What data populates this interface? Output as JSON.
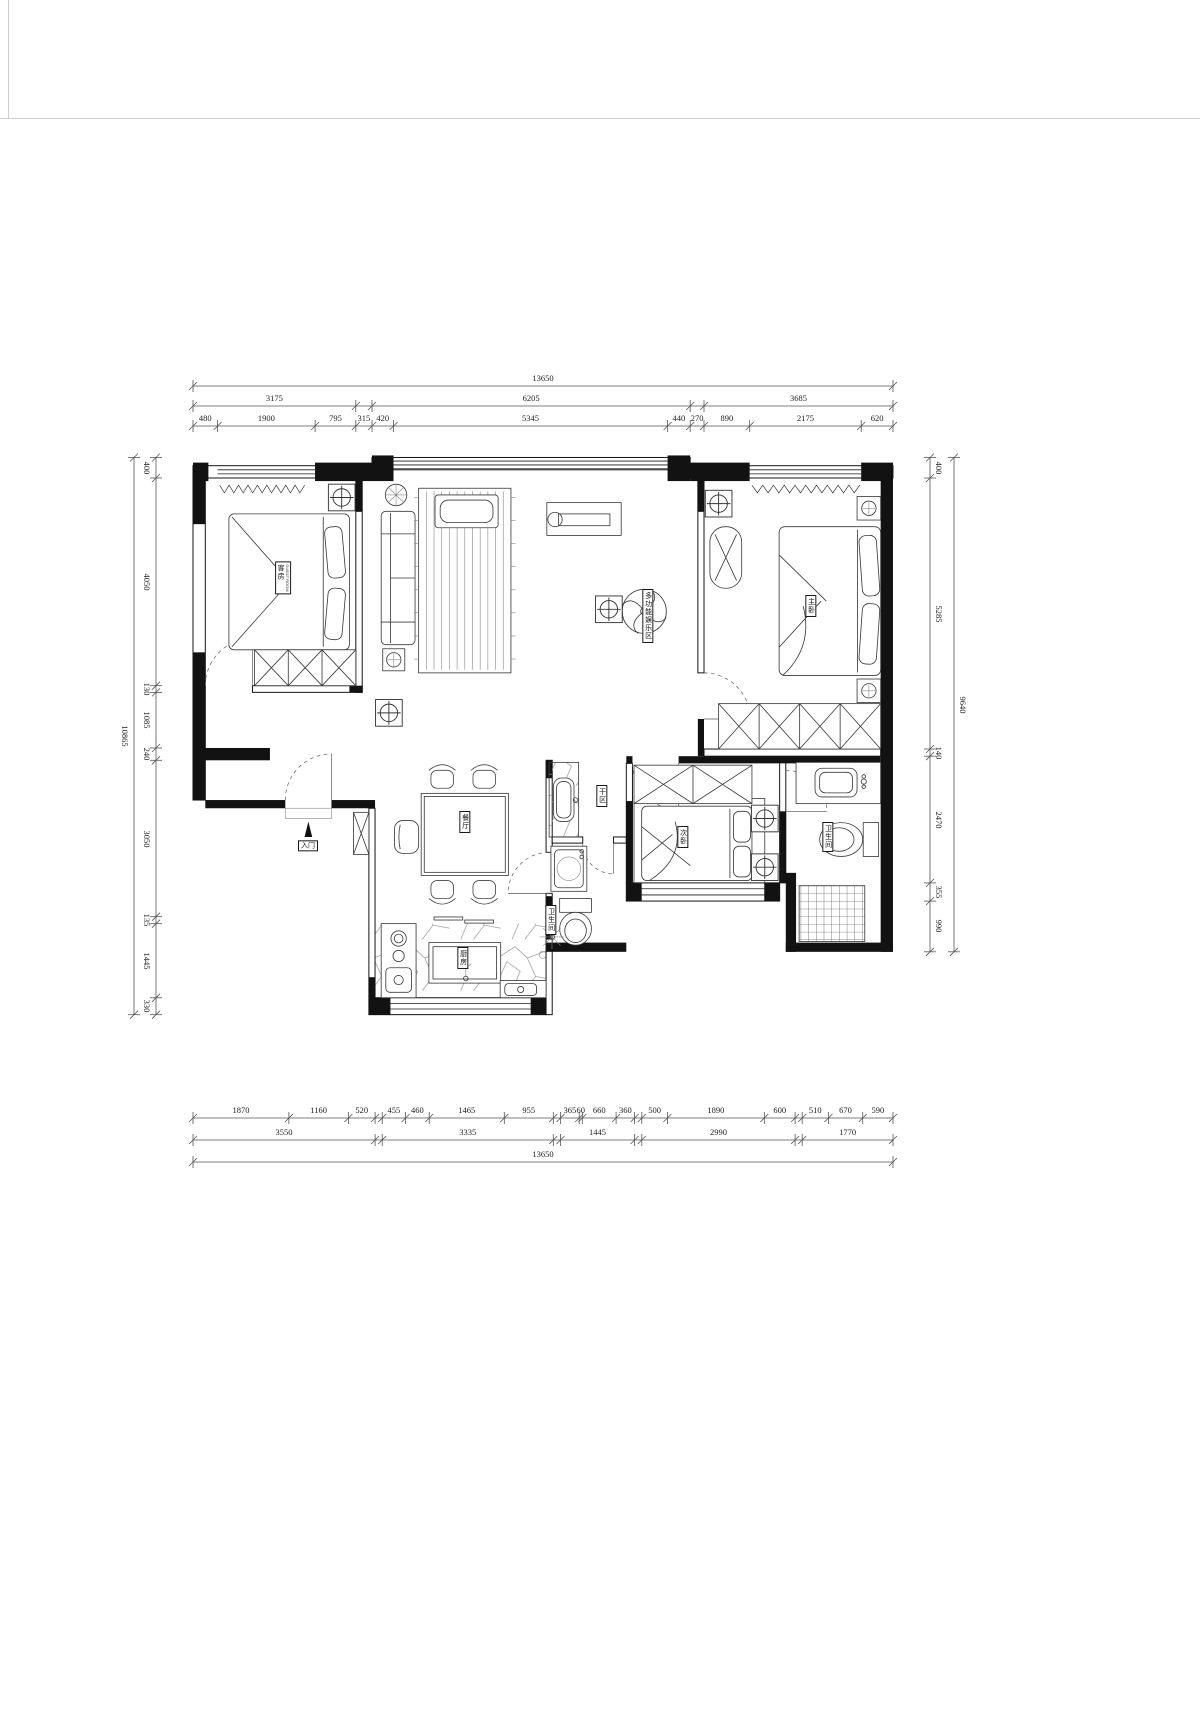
{
  "rooms": {
    "guest_cn": "客房",
    "guest_en": "GUEST ROOM",
    "living": "多功能娱乐区",
    "master": "主卧",
    "second": "次卧",
    "dining": "餐厅",
    "kitchen": "厨房",
    "dry_area": "干区",
    "bath_center": "卫生间",
    "bath_right": "卫生间",
    "entrance": "入门"
  },
  "dims": {
    "top": {
      "total": "13650",
      "mid": [
        "3175",
        "6205",
        "3685"
      ],
      "detail": [
        "480",
        "1900",
        "795",
        "315",
        "420",
        "5345",
        "440",
        "270",
        "890",
        "2175",
        "620"
      ]
    },
    "bottom": {
      "total": "13650",
      "mid": [
        "3550",
        "3335",
        "1445",
        "2990",
        "1770"
      ],
      "detail": [
        "1870",
        "1160",
        "520",
        "455",
        "460",
        "1465",
        "955",
        "365",
        "60",
        "660",
        "360",
        "500",
        "1890",
        "600",
        "510",
        "670",
        "590"
      ]
    },
    "left": {
      "total": "10865",
      "detail": [
        "400",
        "4050",
        "130",
        "1085",
        "240",
        "3050",
        "135",
        "1445",
        "330"
      ]
    },
    "right": {
      "total": "9640",
      "detail": [
        "400",
        "5285",
        "140",
        "2470",
        "355",
        "990"
      ]
    }
  }
}
